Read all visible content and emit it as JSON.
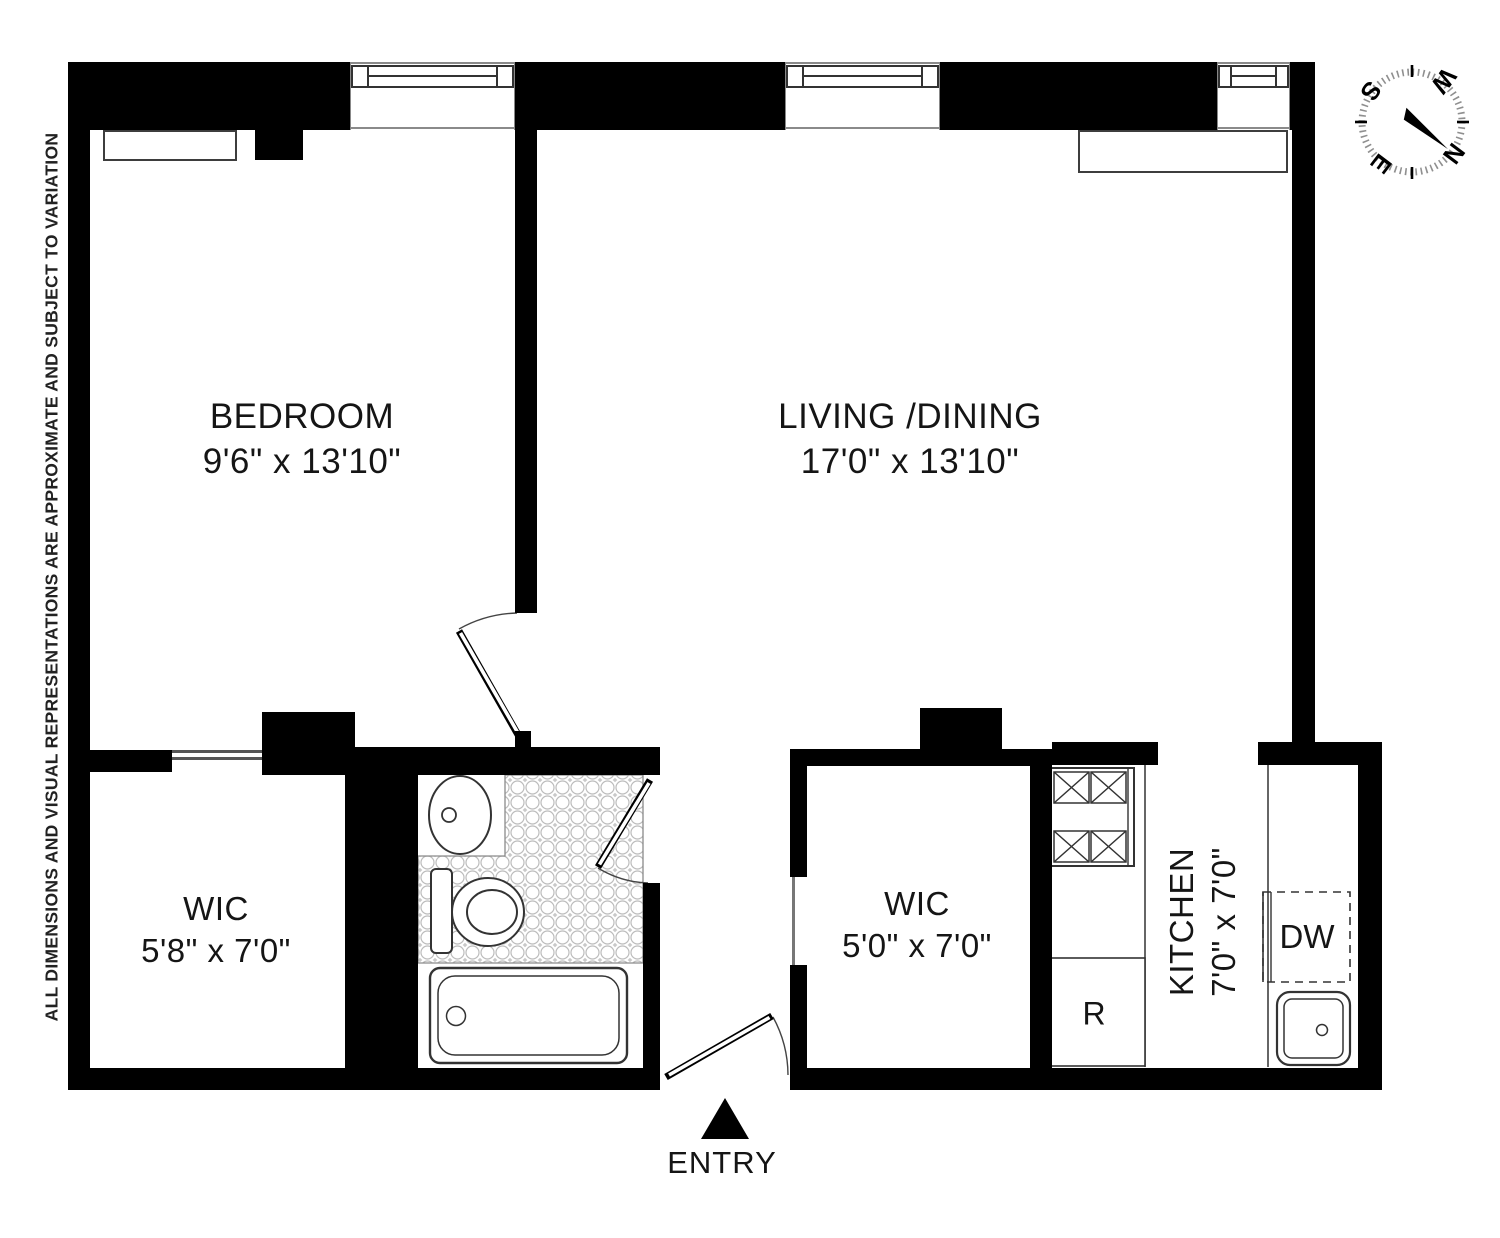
{
  "disclaimer": "ALL DIMENSIONS AND VISUAL REPRESENTATIONS ARE APPROXIMATE AND SUBJECT TO VARIATION",
  "rooms": {
    "bedroom": {
      "name": "BEDROOM",
      "dims": "9'6\" x 13'10\""
    },
    "living_dining": {
      "name": "LIVING /DINING",
      "dims": "17'0\" x 13'10\""
    },
    "wic_left": {
      "name": "WIC",
      "dims": "5'8\" x 7'0\""
    },
    "wic_right": {
      "name": "WIC",
      "dims": "5'0\" x 7'0\""
    },
    "kitchen": {
      "name": "KITCHEN",
      "dims": "7'0\" x 7'0\""
    }
  },
  "appliances": {
    "dishwasher_label": "DW",
    "refrigerator_label": "R"
  },
  "entry": {
    "label": "ENTRY"
  },
  "compass": {
    "north": "N",
    "south": "S",
    "east": "E",
    "west": "W"
  },
  "colors": {
    "wall": "#000000",
    "fixture_line": "#3d3d3d",
    "tile_line": "#bcbcbc"
  }
}
